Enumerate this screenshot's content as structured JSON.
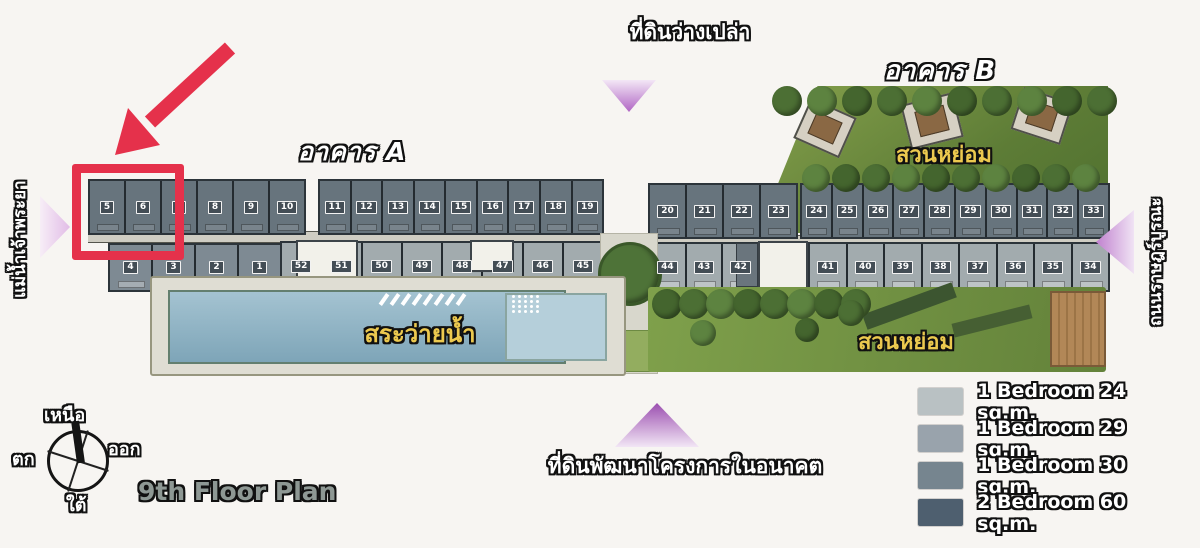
{
  "page": {
    "background": "#f7f5f2"
  },
  "labels": {
    "vacant_land": "ที่ดินว่างเปล่า",
    "future_land": "ที่ดินพัฒนาโครงการในอนาคต",
    "building_a": "อาคาร A",
    "building_b": "อาคาร B",
    "pool": "สระว่ายน้ำ",
    "garden_top": "สวนหย่อม",
    "garden_bottom": "สวนหย่อม",
    "river": "แม่น้ำเจ้าพระยา",
    "road": "ถนนราษฎร์บูรณะ",
    "plan_title": "9th Floor Plan"
  },
  "compass": {
    "north": "เหนือ",
    "south": "ใต้",
    "east": "ออก",
    "west": "ตก"
  },
  "units": {
    "a_top_left": [
      "5",
      "6",
      "7",
      "8",
      "9",
      "10"
    ],
    "a_top_right": [
      "11",
      "12",
      "13",
      "14",
      "15",
      "16",
      "17",
      "18",
      "19"
    ],
    "b_top_left": [
      "20",
      "21",
      "22",
      "23"
    ],
    "b_top_right": [
      "24",
      "25",
      "26",
      "27",
      "28",
      "29",
      "30",
      "31",
      "32",
      "33"
    ],
    "a_bottom_left": [
      "4",
      "3",
      "2",
      "1"
    ],
    "a_bottom_right": [
      "52",
      "51",
      "50",
      "49",
      "48",
      "47",
      "46",
      "45"
    ],
    "b_bottom_left": [
      "44",
      "43",
      "42"
    ],
    "b_bottom_right": [
      "41",
      "40",
      "39",
      "38",
      "37",
      "36",
      "35",
      "34"
    ]
  },
  "legend": [
    {
      "color": "#b9c1c3",
      "label": "1 Bedroom 24 sq.m."
    },
    {
      "color": "#99a3ac",
      "label": "1 Bedroom 29 sq.m."
    },
    {
      "color": "#76858f",
      "label": "1 Bedroom 30 sq.m."
    },
    {
      "color": "#4e5f6f",
      "label": "2 Bedroom 60 sq.m."
    }
  ],
  "annotation": {
    "color": "#e5314b",
    "highlighted_unit": "5"
  },
  "accents": {
    "triangle_purple": "#b066c4",
    "garden_green": "#6f8f42",
    "pool_blue": "#8fb2c4"
  }
}
